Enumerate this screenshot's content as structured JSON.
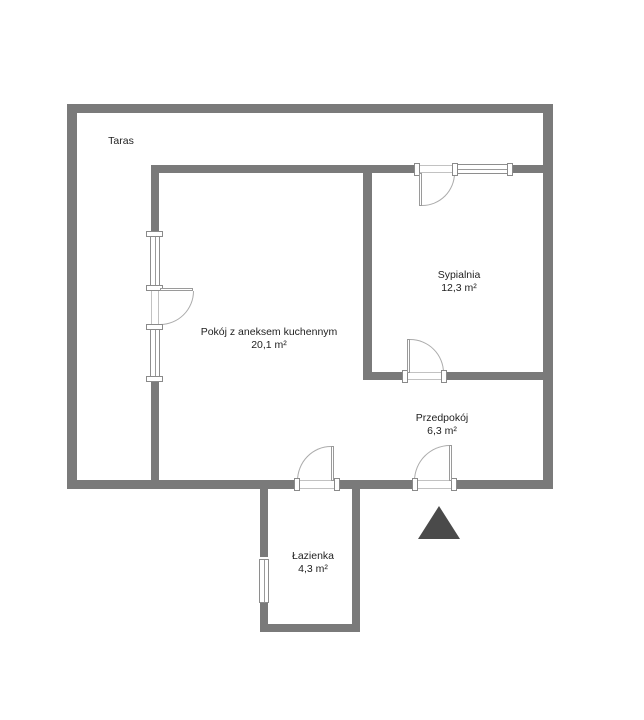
{
  "floorplan": {
    "rooms": [
      {
        "name": "Taras",
        "area": ""
      },
      {
        "name": "Pokój z aneksem kuchennym",
        "area": "20,1 m²"
      },
      {
        "name": "Sypialnia",
        "area": "12,3 m²"
      },
      {
        "name": "Przedpokój",
        "area": "6,3 m²"
      },
      {
        "name": "Łazienka",
        "area": "4,3 m²"
      }
    ],
    "colors": {
      "wall": "#7a7a7a",
      "window_line": "#8e8e8e",
      "door_line": "#ababab",
      "text": "#1f1f1f",
      "entrance_marker": "#4a4a4a",
      "background": "#ffffff"
    },
    "icons": {
      "entrance_marker": "triangle-up"
    }
  }
}
